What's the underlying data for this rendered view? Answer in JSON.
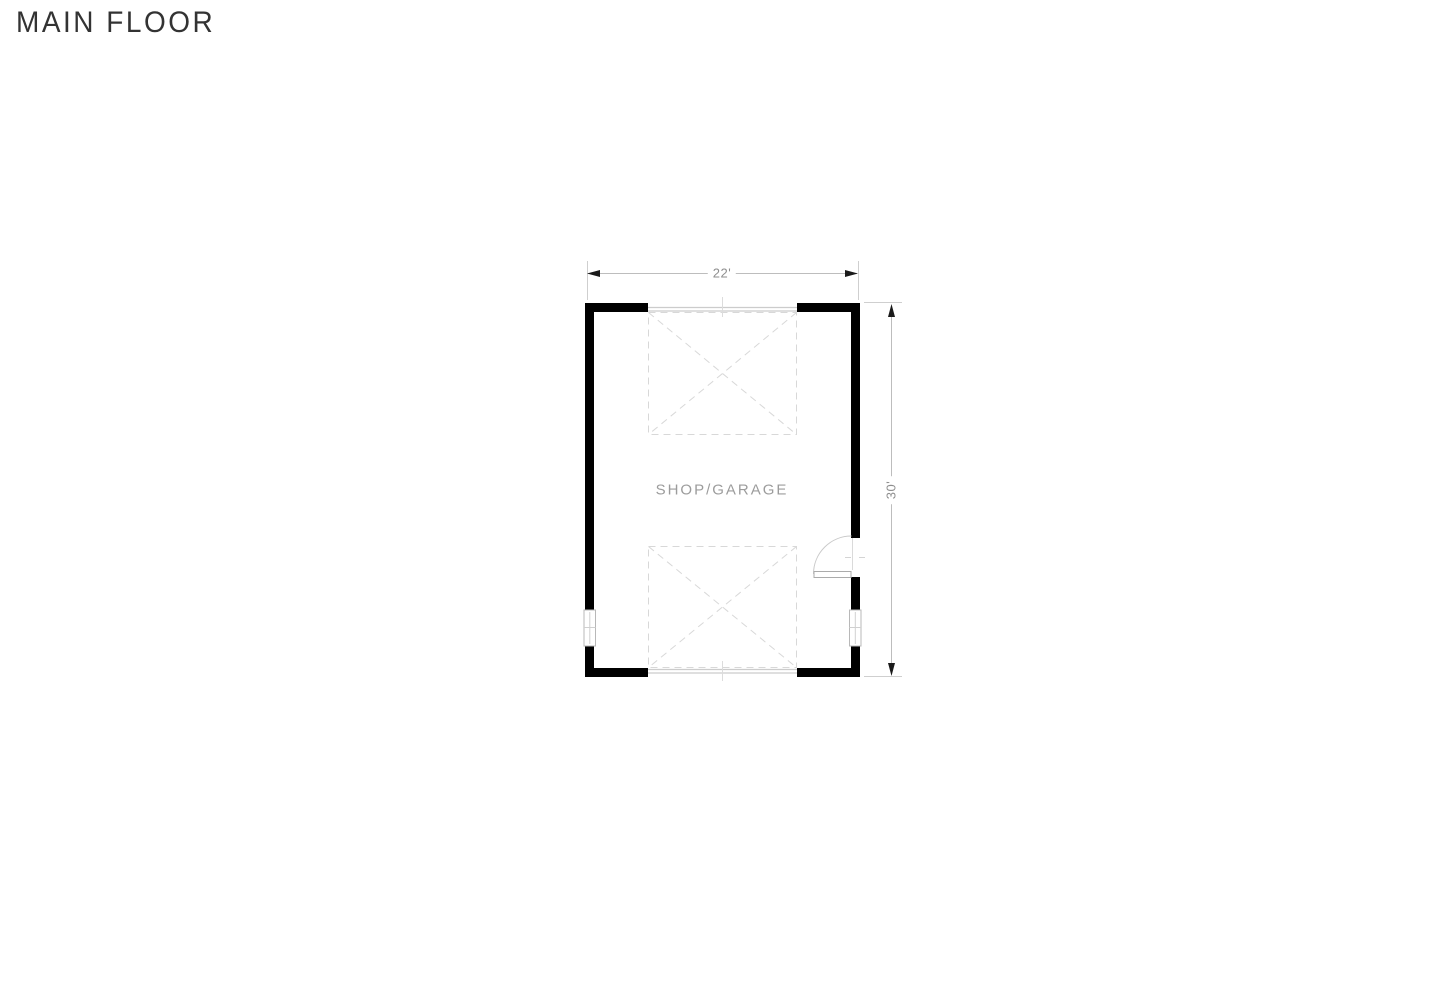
{
  "page": {
    "title": "MAIN FLOOR"
  },
  "floor_plan": {
    "room_label": "SHOP/GARAGE",
    "dimensions": {
      "width": "22'",
      "height": "30'"
    },
    "features": {
      "garage_door_openings": 2,
      "entry_door": "right wall, swings in",
      "windows": [
        "left wall",
        "right wall"
      ]
    }
  },
  "colors": {
    "background": "#ffffff",
    "wall": "#000000",
    "dimension_line": "#bdbdbd",
    "extension_line": "#cfcfcf",
    "arrowhead": "#1a1a1a",
    "dimension_text": "#8e8e8e",
    "room_text": "#9c9c9c",
    "title_text": "#333333",
    "dashed_outline": "#d8d8d8",
    "door_header": "#cccccc",
    "fixture_outline": "#ababab"
  }
}
